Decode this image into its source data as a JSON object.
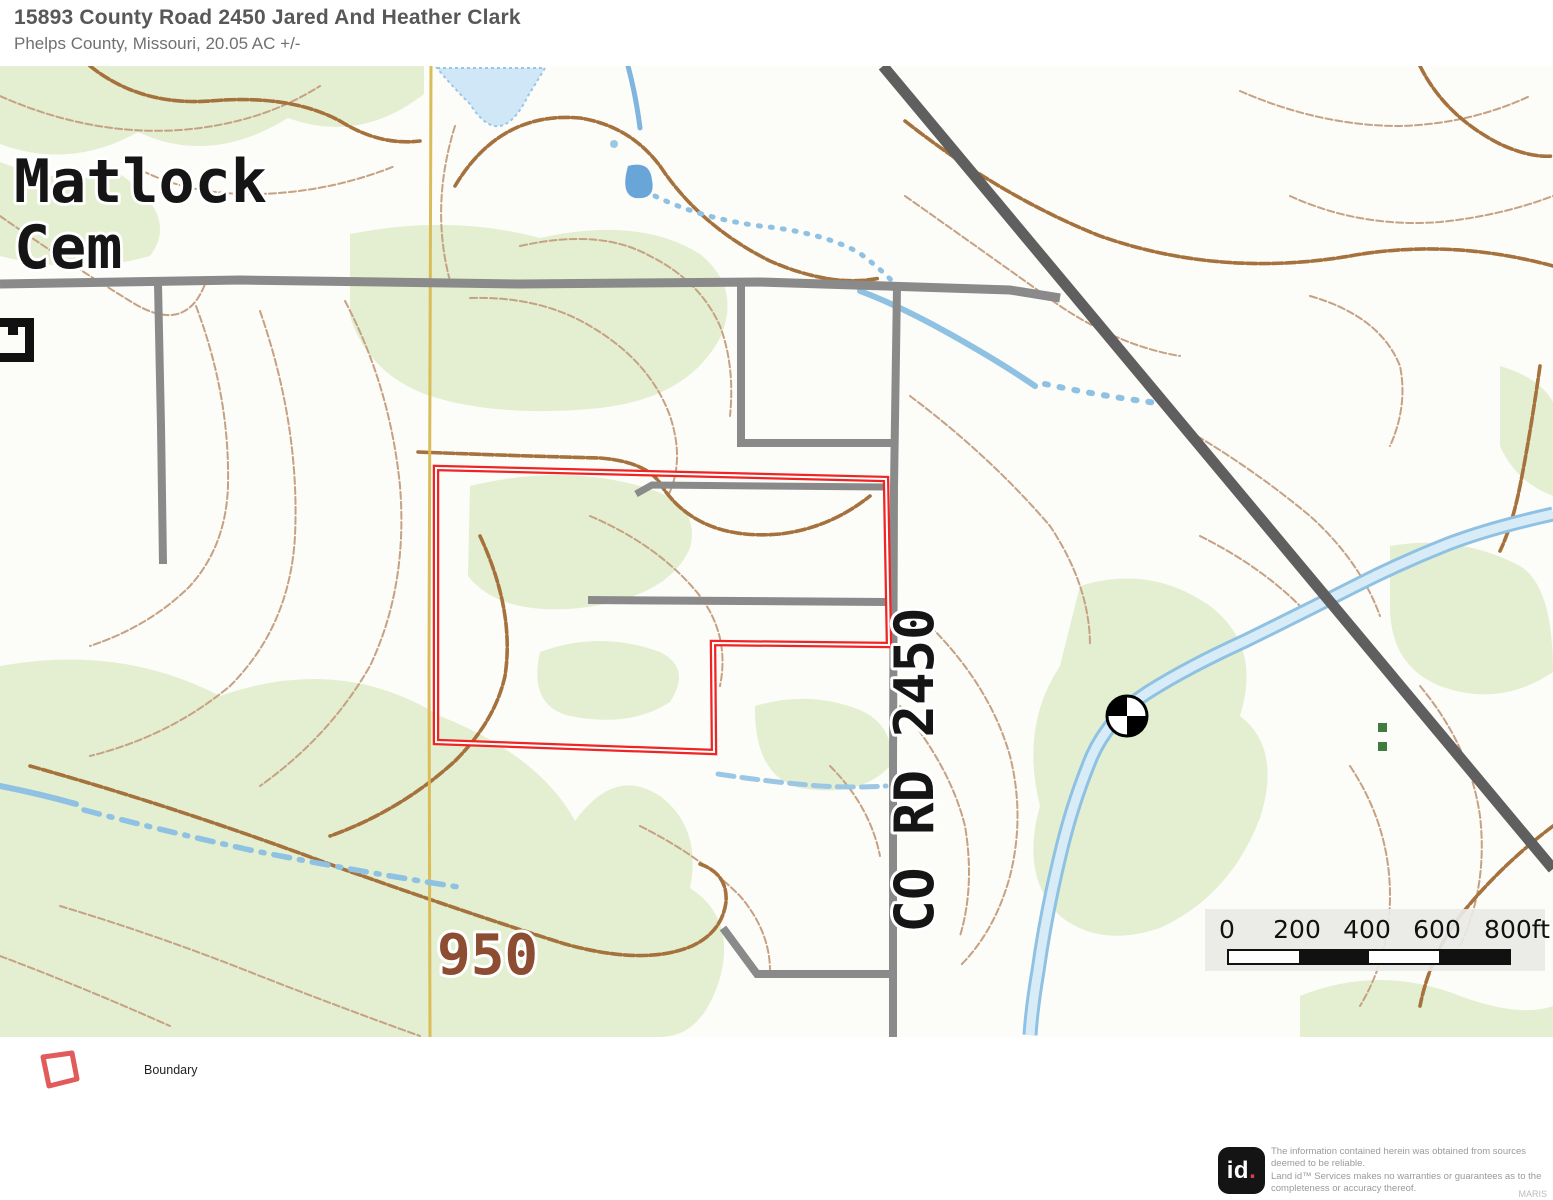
{
  "header": {
    "title": "15893 County Road 2450 Jared And Heather Clark",
    "subtitle": "Phelps County, Missouri, 20.05 AC +/-"
  },
  "map": {
    "labels": {
      "cemetery_line1": "Matlock",
      "cemetery_line2": "Cem",
      "road": "CO RD 2450",
      "contour_elevation": "950"
    },
    "scale_bar": {
      "labels": [
        "0",
        "200",
        "400",
        "600",
        "800ft"
      ]
    },
    "colors": {
      "boundary_red": "#ee2524",
      "water_blue": "#8fc1e3",
      "water_fill": "#d8ecf8",
      "woodland_green": "#e3efd0",
      "contour_index_brown": "#a5713d",
      "contour_thin_brown": "#c6a183",
      "road_gray": "#8a8a8a",
      "road_major_gray": "#5f5f5f",
      "section_line_yellow": "#d9b851"
    }
  },
  "legend": {
    "items": [
      {
        "label": "Boundary"
      }
    ]
  },
  "footer": {
    "logo_text": "id",
    "logo_dot": ".",
    "disclaimer_lines": [
      "The information contained herein was obtained from sources",
      "deemed to be reliable.",
      "Land id™ Services makes no warranties or guarantees as to the",
      "completeness or accuracy thereof."
    ],
    "attribution": "MARIS"
  }
}
